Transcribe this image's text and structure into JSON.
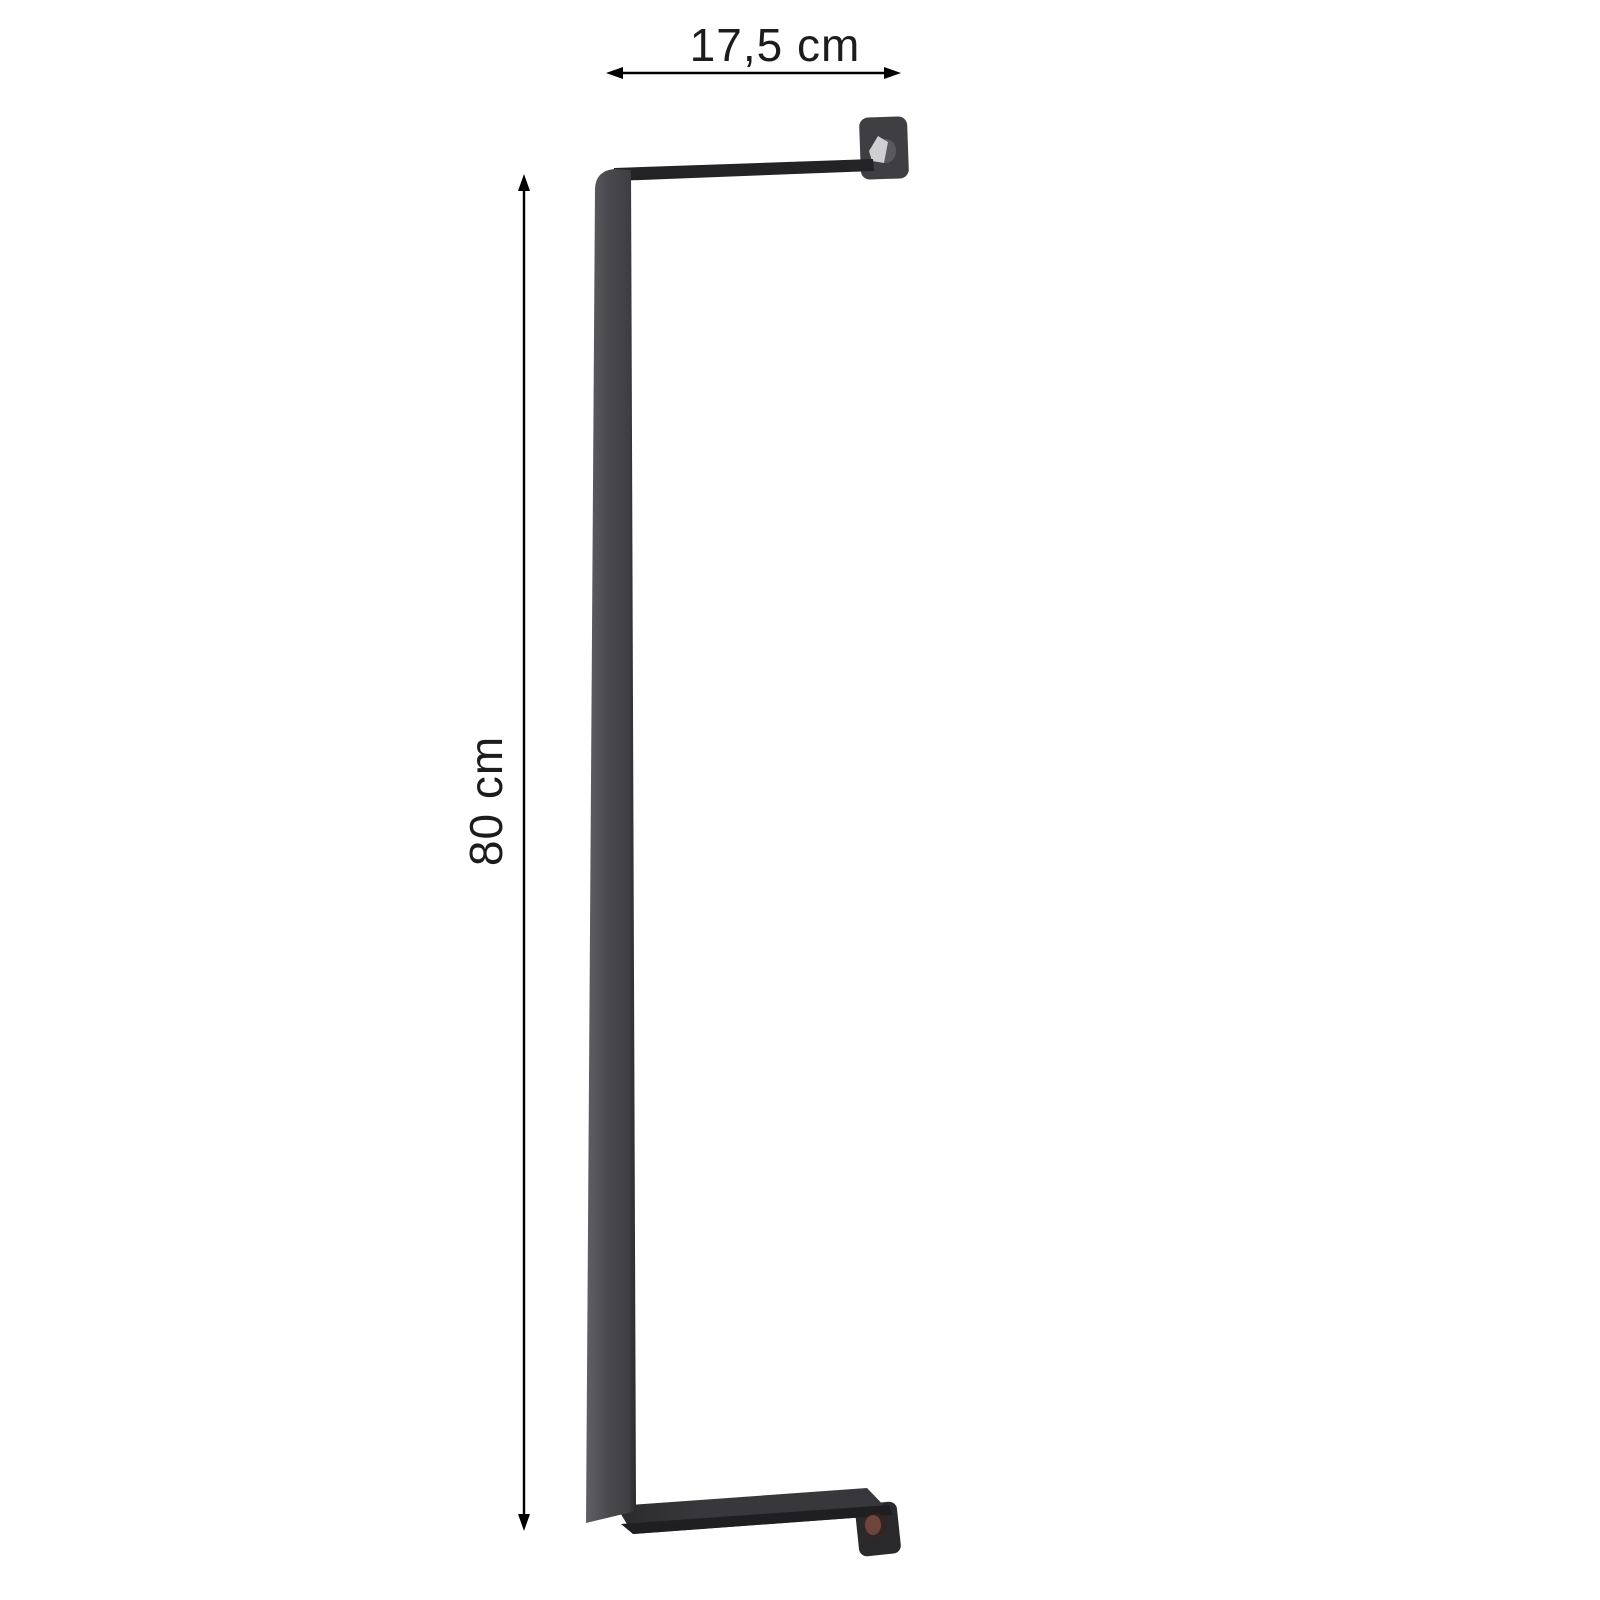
{
  "page": {
    "background": "#ffffff"
  },
  "diagram": {
    "type": "product-dimension-diagram",
    "dimensions": {
      "width_label": "17,5 cm",
      "height_label": "80 cm"
    },
    "annotation": {
      "line_color": "#000000",
      "arrow_color": "#000000",
      "text_color": "#1c1c1c"
    },
    "bracket_colors": {
      "bar_highlight": "#606064",
      "bar_mid": "#4a4a4e",
      "bar_shade": "#3f3f43",
      "bar_edge_dark": "#2a2a2c",
      "top_strip": "#232325",
      "bottom_strip": "#38383c",
      "bottom_strip_edge": "#1f1f21",
      "top_plate": "#3f3f43",
      "bottom_plate": "#2a2a2d",
      "screw_silver_side": "#5a5a5e",
      "screw_silver_face": "#cfcfd2",
      "screw_bronze_rim": "#35241f",
      "screw_bronze": "#6e453d"
    }
  }
}
